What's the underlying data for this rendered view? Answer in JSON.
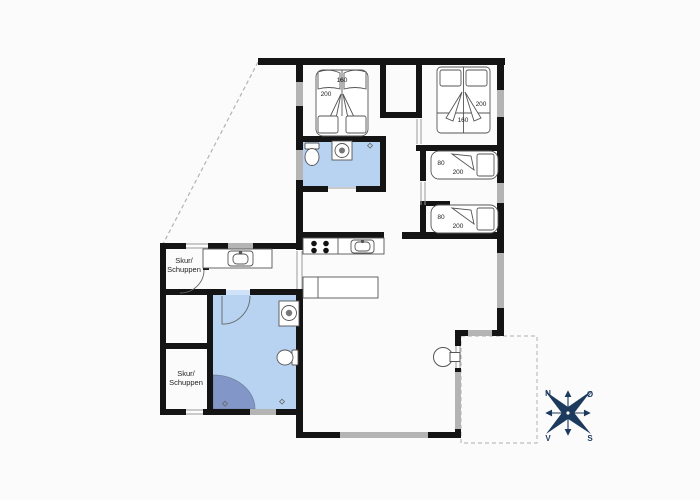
{
  "plan_type": "vacation-house-floor-plan",
  "colors": {
    "wall": "#141414",
    "window": "#b4b4b4",
    "bathroom_fill": "#b7d3f1",
    "shower_fill": "#8296c8",
    "compass": "#1c3a5e",
    "dashed": "#b3b3b3",
    "furniture_outline": "#555555"
  },
  "rooms": {
    "shed_top": {
      "label_line1": "Skur/",
      "label_line2": "Schuppen"
    },
    "shed_bottom": {
      "label_line1": "Skur/",
      "label_line2": "Schuppen"
    }
  },
  "beds": {
    "double_left": {
      "width_cm": "160",
      "length_cm": "200"
    },
    "double_right": {
      "width_cm": "160",
      "length_cm": "200"
    },
    "single_top": {
      "width_cm": "80",
      "length_cm": "200"
    },
    "single_bottom": {
      "width_cm": "80",
      "length_cm": "200"
    }
  },
  "compass": {
    "north": "N",
    "east": "Ø",
    "south": "S",
    "west": "V"
  }
}
